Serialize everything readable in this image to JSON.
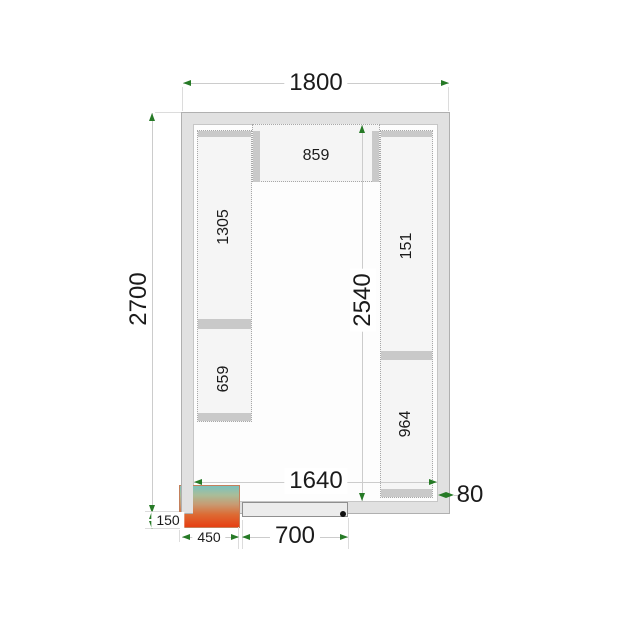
{
  "plan": {
    "outer_width": "1800",
    "outer_depth": "2700",
    "inner_depth": "2540",
    "inner_width": "1640",
    "wall_thickness": "80",
    "unit_overhang": "150",
    "unit_width": "450",
    "door_width": "700",
    "shelf_top": "859",
    "shelf_left_upper": "1305",
    "shelf_left_lower": "659",
    "shelf_right_upper": "151",
    "shelf_right_lower": "964"
  },
  "colors": {
    "dimension_arrow_green": "#267a26",
    "wall_fill": "#e1e1e1",
    "shelf_fill": "#f5f5f5",
    "unit_gradient_top": "#7cc2bd",
    "unit_gradient_bottom": "#e63f12",
    "door_pivot_dot": "#111111"
  }
}
